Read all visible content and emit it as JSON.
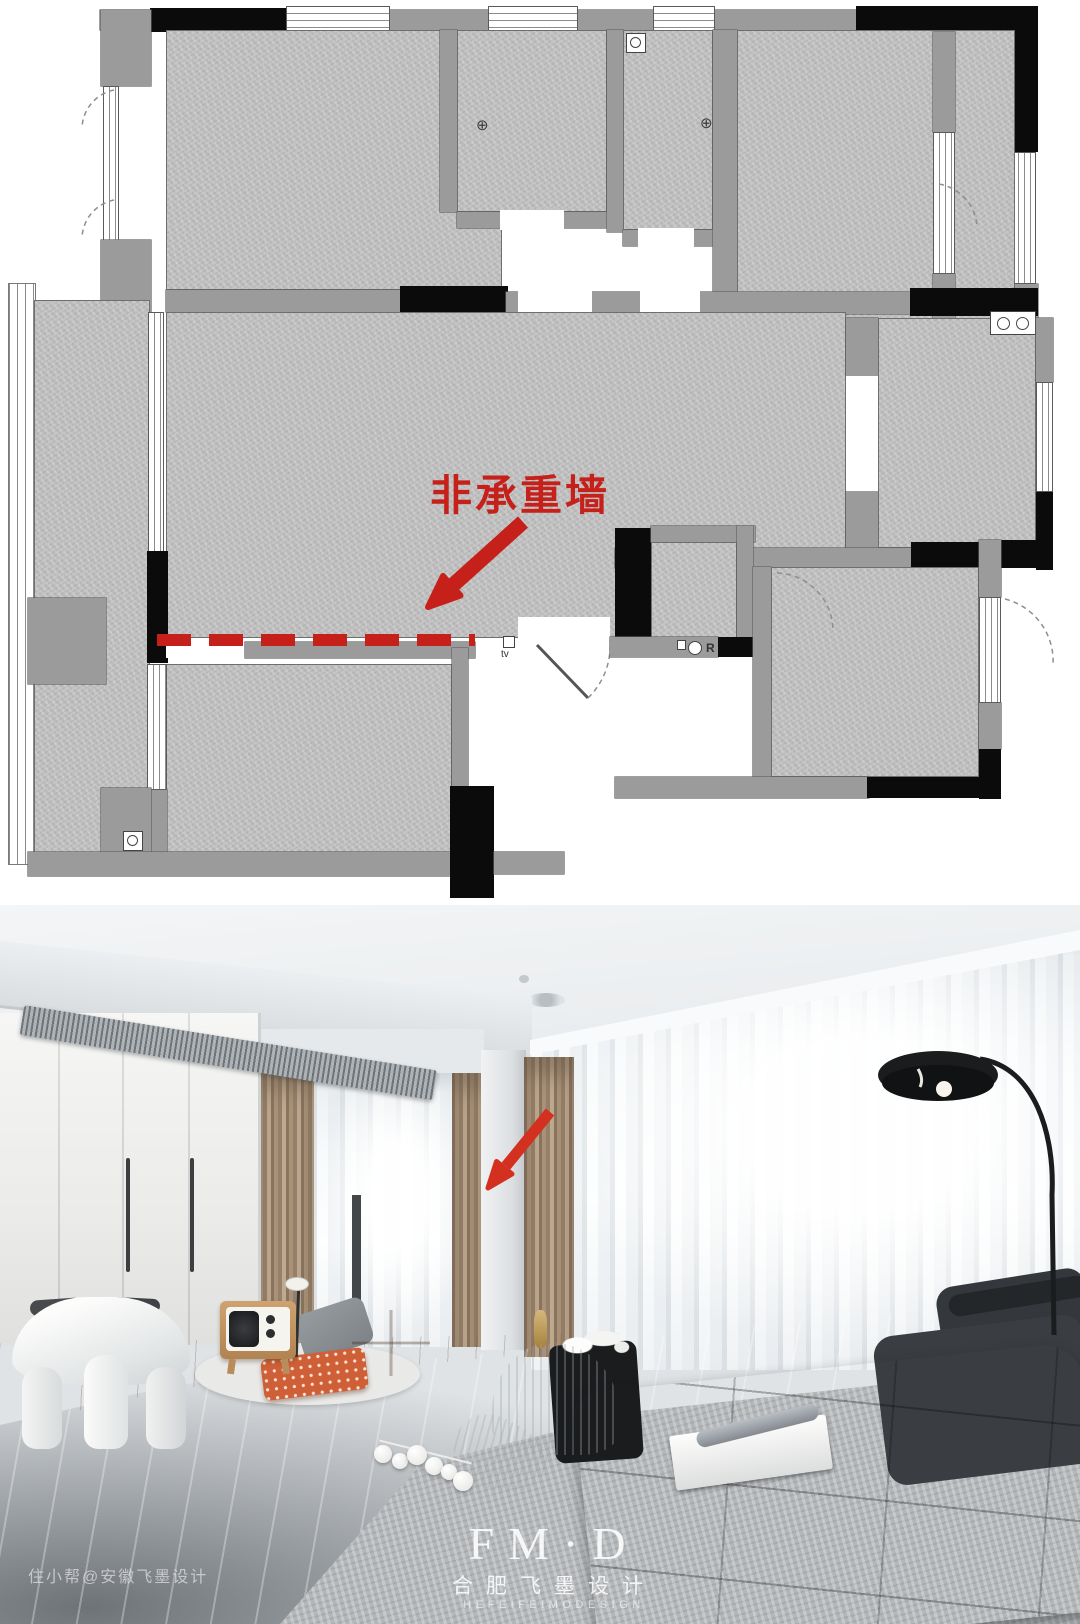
{
  "floorplan": {
    "annotation_label": "非承重墙",
    "annotation_color": "#c5201a",
    "tv_label": "tv",
    "fixture_r_label": "R",
    "drain_icon": "⊕"
  },
  "photo": {
    "watermark_logo": "FM·D",
    "watermark_brand": "合肥飞墨设计",
    "watermark_sub": "HEFEIFEIMODESIGN",
    "watermark_credit": "住小帮@安徽飞墨设计",
    "arrow_color": "#d3301f"
  },
  "palette": {
    "plan_room_gray": "#bcbcbc",
    "plan_wall_gray": "#9b9b9b",
    "plan_wall_black": "#0b0b0b",
    "annotation_red": "#c5201a",
    "curtain_tan": "#a68d72",
    "sofa_charcoal": "#34383c",
    "wood_floor": "#cda87f"
  }
}
